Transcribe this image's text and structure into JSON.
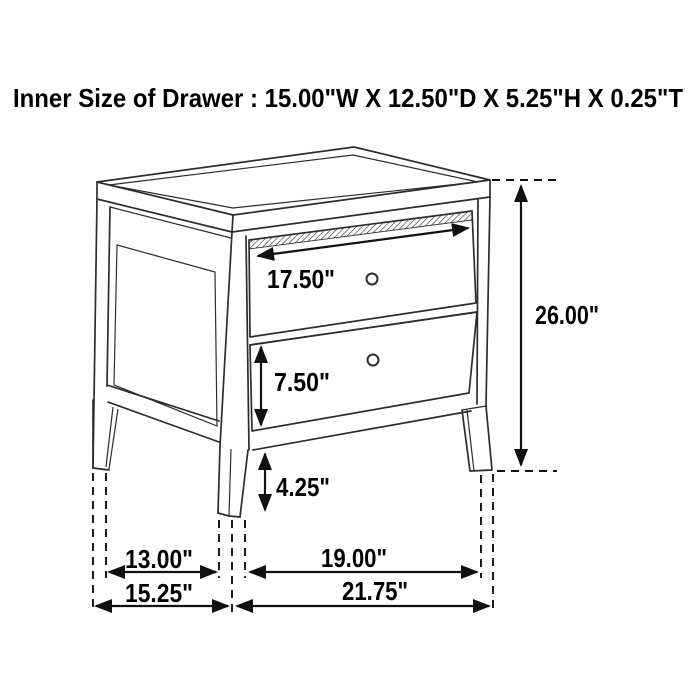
{
  "title": "Inner Size of Drawer : 15.00\"W X 12.50\"D X 5.25\"H X 0.25\"T",
  "dimensions": {
    "top_drawer_width": "17.50\"",
    "bottom_drawer_height": "7.50\"",
    "leg_height": "4.25\"",
    "overall_height": "26.00\"",
    "side_leg_spacing": "13.00\"",
    "front_leg_spacing": "19.00\"",
    "overall_depth": "15.25\"",
    "overall_width": "21.75\""
  },
  "colors": {
    "background": "#ffffff",
    "line": "#2d2d2d",
    "dimension": "#111111",
    "text": "#000000"
  }
}
